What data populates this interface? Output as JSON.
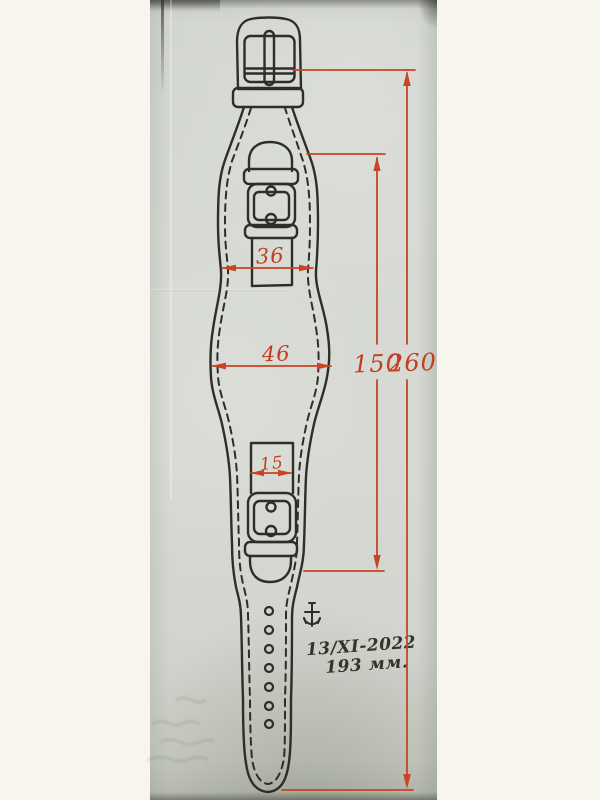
{
  "colors": {
    "margin_background": "#f6f4ec",
    "paper": "#d6d9d3",
    "ink": "#2f2d27",
    "dimension_red": "#c33d1e"
  },
  "diagram": {
    "type": "technical-drawing",
    "subject": "watch cuff strap pattern with buckles",
    "dimensions": {
      "upper_cuff_width": "36",
      "middle_cuff_width": "46",
      "small_strap_width": "15",
      "inner_length": "150",
      "total_length": "260"
    },
    "annotations": {
      "date": "13/XI-2022",
      "length_note": "193 мм."
    },
    "marks": {
      "anchor_symbol": "anchor-glyph"
    }
  }
}
